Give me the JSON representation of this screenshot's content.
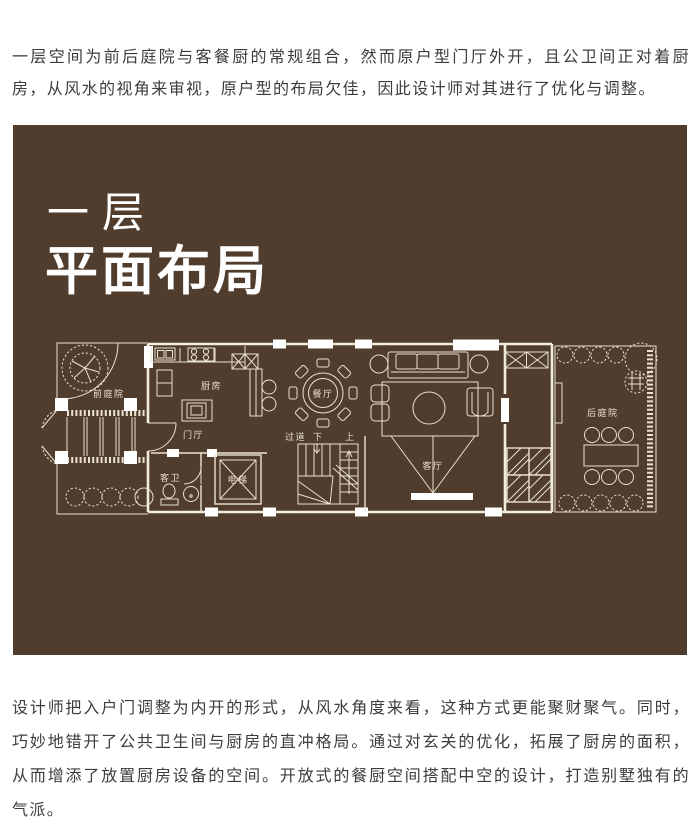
{
  "colors": {
    "panel_bg": "#503d2e",
    "plan_line": "#e9e1d1",
    "title_text": "#ffffff",
    "body_text": "#3c3c3c"
  },
  "intro_text": "一层空间为前后庭院与客餐厨的常规组合，然而原户型门厅外开，且公卫间正对着厨房，从风水的视角来审视，原户型的布局欠佳，因此设计师对其进行了优化与调整。",
  "panel": {
    "title_line1": "一层",
    "title_line2": "平面布局"
  },
  "floorplan": {
    "labels": {
      "front_yard": "前庭院",
      "kitchen": "厨房",
      "foyer": "门厅",
      "guest_bath": "客卫",
      "elevator": "电梯",
      "dining": "餐厅",
      "corridor": "过道",
      "stairs_down": "下",
      "stairs_up": "上",
      "living": "客厅",
      "back_yard": "后庭院"
    }
  },
  "outro_text": "设计师把入户门调整为内开的形式，从风水角度来看，这种方式更能聚财聚气。同时，巧妙地错开了公共卫生间与厨房的直冲格局。通过对玄关的优化，拓展了厨房的面积，从而增添了放置厨房设备的空间。开放式的餐厨空间搭配中空的设计，打造别墅独有的气派。"
}
